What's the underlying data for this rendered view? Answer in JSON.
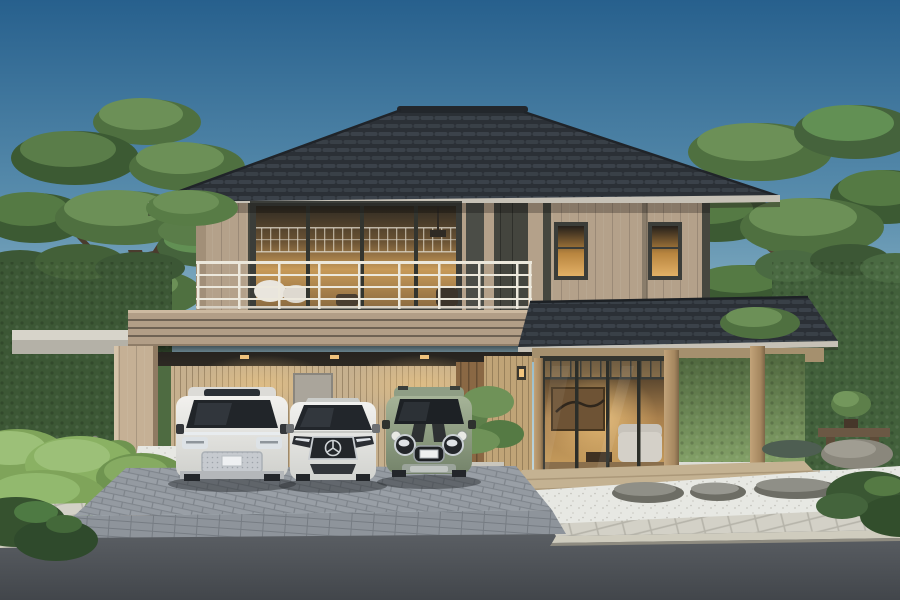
{
  "meta": {
    "title": "Modern Japanese-style two-storey house rendering",
    "description": "Architectural 3D rendering: a two-storey modern Japanese house with dark tiled hip roof, tan panelled walls, lit balcony windows, carport with three parked cars, landscaped pine-and-moss garden with stone lantern, white gravel, paver sidewalk and asphalt road in front under a clear blue sky."
  },
  "palette": {
    "skyTop": "#27608d",
    "skyMid": "#5b8fae",
    "skyLow": "#9dc0cd",
    "skyHorizon": "#cfdfe3",
    "roofBase": "#2b3036",
    "roofTileHi": "#3b424a",
    "ridge": "#23272c",
    "fascia": "#c6c1b6",
    "wall": "#b4a18a",
    "wallLight": "#c6b39a",
    "trimDark": "#46473f",
    "panelDark": "#4b4d47",
    "railing": "#ece8dc",
    "band": "#b29e87",
    "bandGroove": "#6f6254",
    "carportBack": "#c6b08e",
    "woodPost": "#b5976e",
    "doorWood": "#8a6844",
    "deck": "#c4b292",
    "glassWarm": "#e3b166",
    "glassDark": "#22262b",
    "lampWarm": "#f2c57e",
    "ivy": "#42603b",
    "pineDark": "#3c5a33",
    "pineMid": "#4f7040",
    "pineLight": "#6c9057",
    "pineHi": "#84a968",
    "moss": "#7fa45a",
    "mossHi": "#9cc078",
    "gravel": "#e7e8e3",
    "stoneGrey": "#8a877c",
    "paver": "#d3d1c7",
    "curb": "#cfccbe",
    "cobble": "#999fa6",
    "road": "#575b60",
    "roadDark": "#42464b",
    "carWhite": "#eceded",
    "carGreen": "#98a78b",
    "chrome": "#c8ccd0",
    "lanternGrey": "#8a8a80"
  },
  "scene": {
    "sky": {
      "label": "clear gradient sky, deep blue to pale horizon"
    },
    "house": {
      "label": "two-storey modern Japanese house",
      "roof": "dark grey tiled hip roof with wide eaves",
      "upper_floor": "tan vertical-panel walls, full-width warm-lit glazing behind a white balcony railing, two small lit windows on right wing, dark accent panels",
      "balcony": "white horizontal-bar metal railing with outdoor chairs",
      "lower_floor": "carport with slatted back wall, wooden entry door, covered engawa porch with timber posts and floor-to-ceiling living-room glazing",
      "interior": "warm lit living room with sofa, artwork and shelving visible through glass"
    },
    "vehicles": [
      {
        "label": "white electric MPV van with chrome grille",
        "color_name": "white"
      },
      {
        "label": "white Mercedes-Benz sedan with star grille",
        "color_name": "white"
      },
      {
        "label": "sage-green MINI Countryman SUV with black bonnet stripes",
        "color_name": "sage green"
      }
    ],
    "garden": {
      "left": "sculpted niwaki pine trees, moss mounds, white gravel, granite stone lantern, rocks, clipped hedge",
      "right": "large pine over ivy-covered wall, koi pond edge, timber bench with bonsai, stepping stones in white gravel, shrubs",
      "front": "white gravel strip with flat stepping stones along the porch"
    },
    "street": {
      "driveway": "grey cobblestone paver driveway and brick apron",
      "sidewalk": "light concrete paver sidewalk with curb",
      "road": "dark asphalt road"
    }
  }
}
